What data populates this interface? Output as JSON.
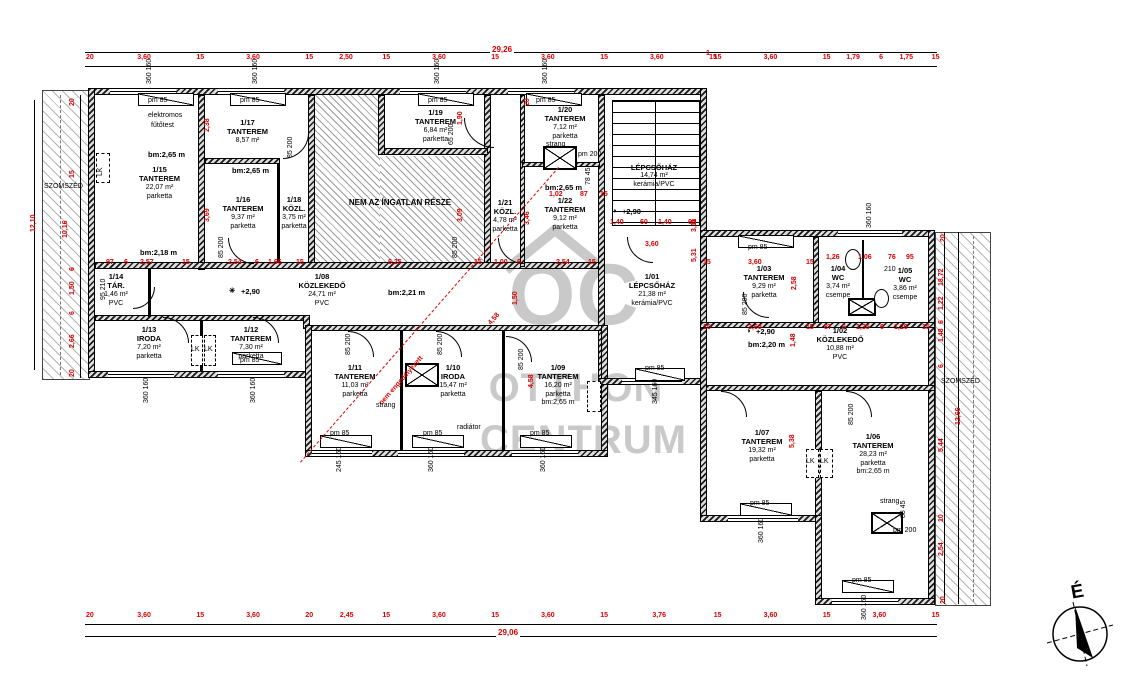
{
  "compass": {
    "label": "É"
  },
  "labels": {
    "neighbor": "SZOMSZÉD",
    "not_property": "NEM AZ ÍNGATLAN RÉSZE",
    "red_note": "nem engedélyezett"
  },
  "watermark": {
    "monogram": "OC",
    "line1": "OTTHON",
    "line2": "CENTRUM"
  },
  "colors": {
    "dim_red": "#d40000",
    "watermark_gray": "#c9c9c9"
  },
  "dims": {
    "top": {
      "total": "29,26",
      "segments": [
        "20",
        "3,60",
        "15",
        "3,60",
        "15",
        "2,50",
        "15",
        "3,60",
        "15",
        "3,60",
        "15",
        "3,60",
        "15",
        "1",
        "15",
        "3,60",
        "15",
        "1,79",
        "6",
        "1,75",
        "15"
      ]
    },
    "bottom": {
      "total": "29,06",
      "segments": [
        "20",
        "3,60",
        "15",
        "3,60",
        "20",
        "2,45",
        "15",
        "3,60",
        "15",
        "3,60",
        "15",
        "3,76",
        "15",
        "3,60",
        "15",
        "3,60",
        "15"
      ]
    }
  },
  "rooms": [
    {
      "id": "1/15",
      "name": "TANTEREM",
      "area": "22,07 m²",
      "floor": "parketta",
      "x": 112,
      "y": 165,
      "w": 95
    },
    {
      "id": "1/17",
      "name": "TANTEREM",
      "area": "8,57 m²",
      "floor": "",
      "x": 205,
      "y": 118,
      "w": 85
    },
    {
      "id": "1/16",
      "name": "TANTEREM",
      "area": "9,37 m²",
      "floor": "parketta",
      "x": 203,
      "y": 195,
      "w": 80
    },
    {
      "id": "1/18",
      "name": "KÖZL.",
      "area": "3,75 m²",
      "floor": "parketta",
      "x": 272,
      "y": 195,
      "w": 44
    },
    {
      "id": "1/19",
      "name": "TANTEREM",
      "area": "6,84 m²",
      "floor": "parketta",
      "x": 388,
      "y": 108,
      "w": 95
    },
    {
      "id": "1/20",
      "name": "TANTEREM",
      "area": "7,12 m²",
      "floor": "parketta",
      "x": 525,
      "y": 105,
      "w": 80
    },
    {
      "id": "1/21",
      "name": "KÖZL.",
      "area": "4,78 m²",
      "floor": "parketta",
      "x": 484,
      "y": 198,
      "w": 42
    },
    {
      "id": "1/22",
      "name": "TANTEREM",
      "area": "9,12 m²",
      "floor": "parketta",
      "x": 525,
      "y": 196,
      "w": 80
    },
    {
      "id": "",
      "name": "LÉPCSŐHÁZ",
      "area": "14,74 m²",
      "floor": "kerámia/PVC",
      "x": 608,
      "y": 163,
      "w": 92
    },
    {
      "id": "1/01",
      "name": "LÉPCSŐHÁZ",
      "area": "21,38 m²",
      "floor": "kerámia/PVC",
      "x": 600,
      "y": 272,
      "w": 104
    },
    {
      "id": "1/08",
      "name": "KÖZLEKEDŐ",
      "area": "24,71 m²",
      "floor": "PVC",
      "x": 268,
      "y": 272,
      "w": 108
    },
    {
      "id": "1/14",
      "name": "TÁR.",
      "area": "1,46 m²",
      "floor": "PVC",
      "x": 88,
      "y": 272,
      "w": 56
    },
    {
      "id": "1/13",
      "name": "IRODA",
      "area": "7,20 m²",
      "floor": "parketta",
      "x": 108,
      "y": 325,
      "w": 82
    },
    {
      "id": "1/12",
      "name": "TANTEREM",
      "area": "7,30 m²",
      "floor": "parketta",
      "x": 205,
      "y": 325,
      "w": 92
    },
    {
      "id": "1/11",
      "name": "TANTEREM",
      "area": "11,03 m²",
      "floor": "parketta",
      "x": 314,
      "y": 363,
      "w": 82
    },
    {
      "id": "1/10",
      "name": "IRODA",
      "area": "15,47 m²",
      "floor": "parketta",
      "x": 410,
      "y": 363,
      "w": 86
    },
    {
      "id": "1/09",
      "name": "TANTEREM",
      "area": "16,20 m²",
      "floor": "parketta",
      "extra": "bm:2,65 m",
      "x": 512,
      "y": 363,
      "w": 92
    },
    {
      "id": "1/03",
      "name": "TANTEREM",
      "area": "9,29 m²",
      "floor": "parketta",
      "x": 718,
      "y": 264,
      "w": 92
    },
    {
      "id": "1/04",
      "name": "WC",
      "area": "3,74 m²",
      "floor": "csempe",
      "x": 816,
      "y": 264,
      "w": 44
    },
    {
      "id": "1/05",
      "name": "WC",
      "area": "3,86 m²",
      "floor": "csempe",
      "x": 882,
      "y": 266,
      "w": 46
    },
    {
      "id": "1/02",
      "name": "KÖZLEKEDŐ",
      "area": "10,88 m²",
      "floor": "PVC",
      "x": 786,
      "y": 326,
      "w": 108
    },
    {
      "id": "1/07",
      "name": "TANTEREM",
      "area": "19,32 m²",
      "floor": "parketta",
      "x": 716,
      "y": 428,
      "w": 92
    },
    {
      "id": "1/06",
      "name": "TANTEREM",
      "area": "28,23 m²",
      "floor": "parketta",
      "extra": "bm:2,65 m",
      "x": 822,
      "y": 432,
      "w": 102
    }
  ],
  "annotations": [
    {
      "t": "97",
      "x": 106,
      "y": 259
    },
    {
      "t": "6",
      "x": 124,
      "y": 259
    },
    {
      "t": "2,57",
      "x": 140,
      "y": 259
    },
    {
      "t": "15",
      "x": 182,
      "y": 259
    },
    {
      "t": "2,54",
      "x": 228,
      "y": 259
    },
    {
      "t": "6",
      "x": 255,
      "y": 259
    },
    {
      "t": "1,66",
      "x": 268,
      "y": 259
    },
    {
      "t": "15",
      "x": 296,
      "y": 259
    },
    {
      "t": "6,25",
      "x": 388,
      "y": 259
    },
    {
      "t": "15",
      "x": 474,
      "y": 259
    },
    {
      "t": "1,00",
      "x": 494,
      "y": 259
    },
    {
      "t": "6",
      "x": 517,
      "y": 259
    },
    {
      "t": "2,54",
      "x": 556,
      "y": 259
    },
    {
      "t": "15",
      "x": 588,
      "y": 259
    },
    {
      "t": "1,02",
      "x": 549,
      "y": 191
    },
    {
      "t": "87",
      "x": 580,
      "y": 191
    },
    {
      "t": "15",
      "x": 600,
      "y": 191
    },
    {
      "t": "1,40",
      "x": 610,
      "y": 219
    },
    {
      "t": "60",
      "x": 640,
      "y": 219
    },
    {
      "t": "1,40",
      "x": 658,
      "y": 219
    },
    {
      "t": "65",
      "x": 688,
      "y": 219
    },
    {
      "t": "3,60",
      "x": 645,
      "y": 241
    },
    {
      "t": "1",
      "x": 706,
      "y": 50
    },
    {
      "t": "15",
      "x": 703,
      "y": 259
    },
    {
      "t": "3,60",
      "x": 748,
      "y": 259
    },
    {
      "t": "15",
      "x": 806,
      "y": 259
    },
    {
      "t": "1,26",
      "x": 826,
      "y": 254
    },
    {
      "t": "1,06",
      "x": 858,
      "y": 254
    },
    {
      "t": "76",
      "x": 888,
      "y": 254
    },
    {
      "t": "95",
      "x": 906,
      "y": 254
    },
    {
      "t": "15",
      "x": 703,
      "y": 324
    },
    {
      "t": "3,60",
      "x": 748,
      "y": 324
    },
    {
      "t": "15",
      "x": 806,
      "y": 324
    },
    {
      "t": "87",
      "x": 824,
      "y": 324
    },
    {
      "t": "6",
      "x": 842,
      "y": 324
    },
    {
      "t": "1,35",
      "x": 856,
      "y": 324
    },
    {
      "t": "6",
      "x": 880,
      "y": 324
    },
    {
      "t": "1,26",
      "x": 894,
      "y": 324
    },
    {
      "t": "15",
      "x": 922,
      "y": 324
    },
    {
      "t": "2,38",
      "x": 204,
      "y": 132,
      "r": -90
    },
    {
      "t": "3,69",
      "x": 204,
      "y": 222,
      "r": -90
    },
    {
      "t": "1,90",
      "x": 457,
      "y": 125,
      "r": -90
    },
    {
      "t": "3,09",
      "x": 457,
      "y": 222,
      "r": -90
    },
    {
      "t": "20",
      "x": 524,
      "y": 106,
      "r": -90
    },
    {
      "t": "3,46",
      "x": 524,
      "y": 225,
      "r": -90
    },
    {
      "t": "1,50",
      "x": 512,
      "y": 305,
      "r": -90
    },
    {
      "t": "5,31",
      "x": 691,
      "y": 262,
      "r": -90
    },
    {
      "t": "3,11",
      "x": 691,
      "y": 232,
      "r": -90
    },
    {
      "t": "2,58",
      "x": 791,
      "y": 290,
      "r": -90
    },
    {
      "t": "1,48",
      "x": 790,
      "y": 347,
      "r": -90
    },
    {
      "t": "5,38",
      "x": 789,
      "y": 448,
      "r": -90
    },
    {
      "t": "4,58",
      "x": 528,
      "y": 388,
      "r": -90
    },
    {
      "t": "4,58",
      "x": 487,
      "y": 322,
      "r": -49
    },
    {
      "t": "20",
      "x": 69,
      "y": 106,
      "r": -90
    },
    {
      "t": "15",
      "x": 69,
      "y": 178,
      "r": -90
    },
    {
      "t": "10,16",
      "x": 62,
      "y": 238,
      "r": -90
    },
    {
      "t": "6",
      "x": 69,
      "y": 271,
      "r": -90
    },
    {
      "t": "1,50",
      "x": 69,
      "y": 295,
      "r": -90
    },
    {
      "t": "6",
      "x": 69,
      "y": 315,
      "r": -90
    },
    {
      "t": "2,66",
      "x": 69,
      "y": 348,
      "r": -90
    },
    {
      "t": "20",
      "x": 69,
      "y": 377,
      "r": -90
    },
    {
      "t": "12,10",
      "x": 30,
      "y": 232,
      "r": -90
    },
    {
      "t": "20",
      "x": 940,
      "y": 242,
      "r": -90
    },
    {
      "t": "18,72",
      "x": 938,
      "y": 286,
      "r": -90
    },
    {
      "t": "1,22",
      "x": 938,
      "y": 310,
      "r": -90
    },
    {
      "t": "6",
      "x": 938,
      "y": 324,
      "r": -90
    },
    {
      "t": "1,48",
      "x": 938,
      "y": 342,
      "r": -90
    },
    {
      "t": "6",
      "x": 938,
      "y": 368,
      "r": -90
    },
    {
      "t": "12,66",
      "x": 955,
      "y": 425,
      "r": -90
    },
    {
      "t": "5,44",
      "x": 938,
      "y": 452,
      "r": -90
    },
    {
      "t": "10",
      "x": 938,
      "y": 522,
      "r": -90
    },
    {
      "t": "2,54",
      "x": 938,
      "y": 556,
      "r": -90
    },
    {
      "t": "20",
      "x": 940,
      "y": 604,
      "r": -90
    },
    {
      "t": "pm 85",
      "x": 148,
      "y": 97,
      "c": "b"
    },
    {
      "t": "pm 85",
      "x": 240,
      "y": 97,
      "c": "b"
    },
    {
      "t": "pm 85",
      "x": 428,
      "y": 97,
      "c": "b"
    },
    {
      "t": "pm 85",
      "x": 536,
      "y": 97,
      "c": "b"
    },
    {
      "t": "pm 85",
      "x": 748,
      "y": 244,
      "c": "b"
    },
    {
      "t": "pm 85",
      "x": 330,
      "y": 430,
      "c": "b"
    },
    {
      "t": "pm 85",
      "x": 423,
      "y": 430,
      "c": "b"
    },
    {
      "t": "pm 85",
      "x": 530,
      "y": 430,
      "c": "b"
    },
    {
      "t": "pm 85",
      "x": 750,
      "y": 500,
      "c": "b"
    },
    {
      "t": "pm 85",
      "x": 852,
      "y": 577,
      "c": "b"
    },
    {
      "t": "pm 85",
      "x": 645,
      "y": 365,
      "c": "b"
    },
    {
      "t": "pm 85",
      "x": 240,
      "y": 357,
      "c": "b"
    },
    {
      "t": "pm 200",
      "x": 578,
      "y": 151,
      "c": "b"
    },
    {
      "t": "pm 200",
      "x": 893,
      "y": 527,
      "c": "b"
    },
    {
      "t": "strang",
      "x": 546,
      "y": 141,
      "c": "b"
    },
    {
      "t": "strang",
      "x": 376,
      "y": 402,
      "c": "b"
    },
    {
      "t": "strang",
      "x": 880,
      "y": 498,
      "c": "b"
    },
    {
      "t": "radiátor",
      "x": 457,
      "y": 424,
      "c": "b"
    },
    {
      "t": "elektromos",
      "x": 148,
      "y": 112,
      "c": "b"
    },
    {
      "t": "fűtőtest",
      "x": 151,
      "y": 122,
      "c": "b"
    },
    {
      "t": "✳",
      "x": 229,
      "y": 286,
      "c": "bb"
    },
    {
      "t": "+2,90",
      "x": 241,
      "y": 287,
      "c": "bb"
    },
    {
      "t": "◑",
      "x": 612,
      "y": 206,
      "c": "bb"
    },
    {
      "t": "+2,90",
      "x": 622,
      "y": 207,
      "c": "bb"
    },
    {
      "t": "◑",
      "x": 746,
      "y": 326,
      "c": "bb"
    },
    {
      "t": "+2,90",
      "x": 756,
      "y": 327,
      "c": "bb"
    },
    {
      "t": "bm:2,65 m",
      "x": 148,
      "y": 150,
      "c": "bb"
    },
    {
      "t": "bm:2,65 m",
      "x": 232,
      "y": 166,
      "c": "bb"
    },
    {
      "t": "bm:2,65 m",
      "x": 545,
      "y": 183,
      "c": "bb"
    },
    {
      "t": "bm:2,18 m",
      "x": 140,
      "y": 248,
      "c": "bb"
    },
    {
      "t": "bm:2,21 m",
      "x": 388,
      "y": 288,
      "c": "bb"
    },
    {
      "t": "bm:2,20 m",
      "x": 748,
      "y": 340,
      "c": "bb"
    },
    {
      "t": "210",
      "x": 884,
      "y": 266,
      "c": "b"
    },
    {
      "t": "SZOMSZÉD",
      "x": 44,
      "y": 183,
      "c": "b"
    },
    {
      "t": "SZOMSZÉD",
      "x": 941,
      "y": 378,
      "c": "b"
    },
    {
      "t": "360 160",
      "x": 146,
      "y": 84,
      "c": "b",
      "r": -90
    },
    {
      "t": "360 160",
      "x": 252,
      "y": 84,
      "c": "b",
      "r": -90
    },
    {
      "t": "360 160",
      "x": 434,
      "y": 84,
      "c": "b",
      "r": -90
    },
    {
      "t": "360 160",
      "x": 542,
      "y": 84,
      "c": "b",
      "r": -90
    },
    {
      "t": "360 160",
      "x": 866,
      "y": 228,
      "c": "b",
      "r": -90
    },
    {
      "t": "360 160",
      "x": 143,
      "y": 403,
      "c": "b",
      "r": -90
    },
    {
      "t": "360 160",
      "x": 250,
      "y": 403,
      "c": "b",
      "r": -90
    },
    {
      "t": "245 160",
      "x": 336,
      "y": 472,
      "c": "b",
      "r": -90
    },
    {
      "t": "360 160",
      "x": 428,
      "y": 472,
      "c": "b",
      "r": -90
    },
    {
      "t": "360 160",
      "x": 540,
      "y": 472,
      "c": "b",
      "r": -90
    },
    {
      "t": "360 160",
      "x": 758,
      "y": 543,
      "c": "b",
      "r": -90
    },
    {
      "t": "360 160",
      "x": 861,
      "y": 620,
      "c": "b",
      "r": -90
    },
    {
      "t": "345 160",
      "x": 652,
      "y": 404,
      "c": "b",
      "r": -90
    },
    {
      "t": "85 200",
      "x": 218,
      "y": 258,
      "c": "b",
      "r": -90
    },
    {
      "t": "85 200",
      "x": 452,
      "y": 258,
      "c": "b",
      "r": -90
    },
    {
      "t": "85 200",
      "x": 345,
      "y": 355,
      "c": "b",
      "r": -90
    },
    {
      "t": "85 200",
      "x": 437,
      "y": 355,
      "c": "b",
      "r": -90
    },
    {
      "t": "85 200",
      "x": 518,
      "y": 370,
      "c": "b",
      "r": -90
    },
    {
      "t": "65 200",
      "x": 448,
      "y": 145,
      "c": "b",
      "r": -90
    },
    {
      "t": "85 200",
      "x": 287,
      "y": 158,
      "c": "b",
      "r": -90
    },
    {
      "t": "85 200",
      "x": 742,
      "y": 315,
      "c": "b",
      "r": -90
    },
    {
      "t": "85 200",
      "x": 848,
      "y": 425,
      "c": "b",
      "r": -90
    },
    {
      "t": "78 45",
      "x": 585,
      "y": 185,
      "c": "b",
      "r": -90
    },
    {
      "t": "88 45",
      "x": 900,
      "y": 518,
      "c": "b",
      "r": -90
    },
    {
      "t": "95 210",
      "x": 100,
      "y": 300,
      "c": "b",
      "r": -90
    },
    {
      "t": "LK",
      "x": 97,
      "y": 176,
      "c": "b",
      "r": -90
    },
    {
      "t": "LK",
      "x": 191,
      "y": 346,
      "c": "b"
    },
    {
      "t": "LK",
      "x": 204,
      "y": 346,
      "c": "b"
    },
    {
      "t": "LK",
      "x": 806,
      "y": 458,
      "c": "b"
    },
    {
      "t": "LK",
      "x": 820,
      "y": 458,
      "c": "b"
    }
  ]
}
